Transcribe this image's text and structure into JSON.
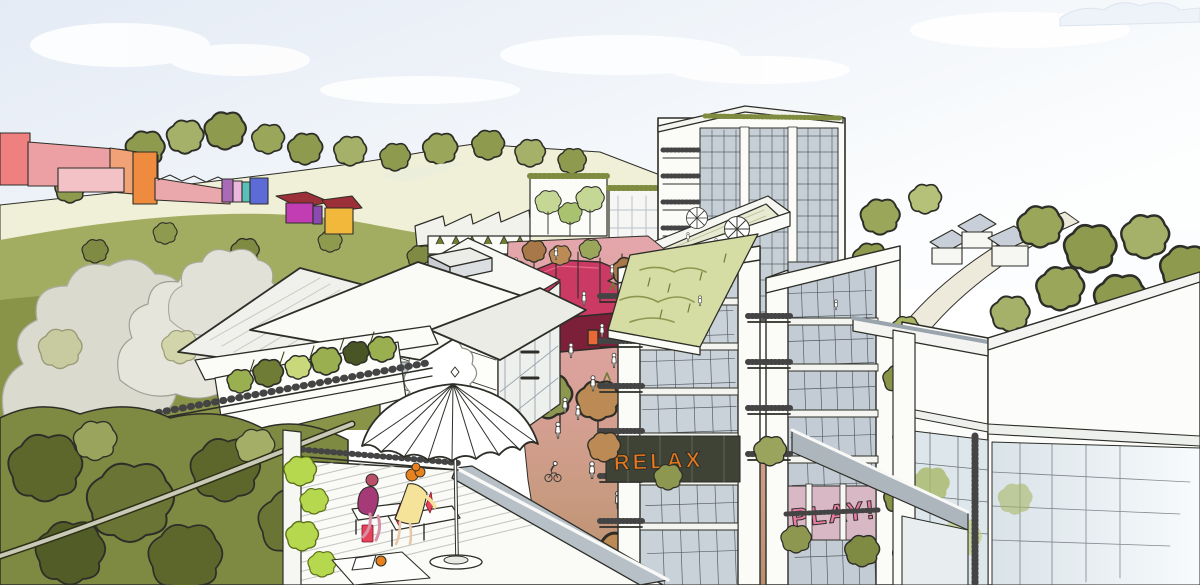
{
  "scene": {
    "title": "Hand-drawn aerial masterplan visualisation",
    "description": "Sketch-style aerial view of a new neighbourhood: a pink pedestrian street with a crimson pavilion, white mid-rise apartment blocks with balconies and green roofs, a rooftop terrace with a parasol and seated figures in the foreground, colourful low-rise buildings and wooded hills beyond",
    "signage": {
      "relax": "RELAX",
      "play": "PLAY!"
    },
    "palette": {
      "sky": "#e7edf6",
      "cloud": "#ffffff",
      "hill_grass": "#eff0d6",
      "tree_olive": "#8d9750",
      "tree_light": "#b5c178",
      "tree_tan": "#bb8a55",
      "street_pink": "#e2a3a8",
      "street_tan": "#bb9070",
      "pavilion_roof": "#cb3a62",
      "pavilion_side": "#7c1f38",
      "building_white": "#fbfbf8",
      "glass": "#c9d2d9",
      "meadow": "#d6dda4",
      "accent_coral": "#ef8080",
      "accent_salmon": "#eda0a4",
      "accent_orange": "#ef8b3e",
      "accent_violet": "#a96ab8",
      "accent_pink": "#edb6dc",
      "accent_teal": "#59c0b8",
      "accent_blue": "#5c6bd6",
      "accent_magenta": "#c23cb4",
      "accent_purple": "#8a4ab0",
      "accent_amber": "#f2b83c",
      "roof_darkred": "#9c3038",
      "sign_relax": "#e8791c",
      "sign_play": "#e87ba4",
      "drink_red": "#e8425a",
      "person_magenta": "#a63a78",
      "person_yellow": "#f4e398",
      "hair_orange": "#e8821e",
      "foliage_bright": "#b5d84e",
      "ink": "#2e2e28"
    }
  }
}
